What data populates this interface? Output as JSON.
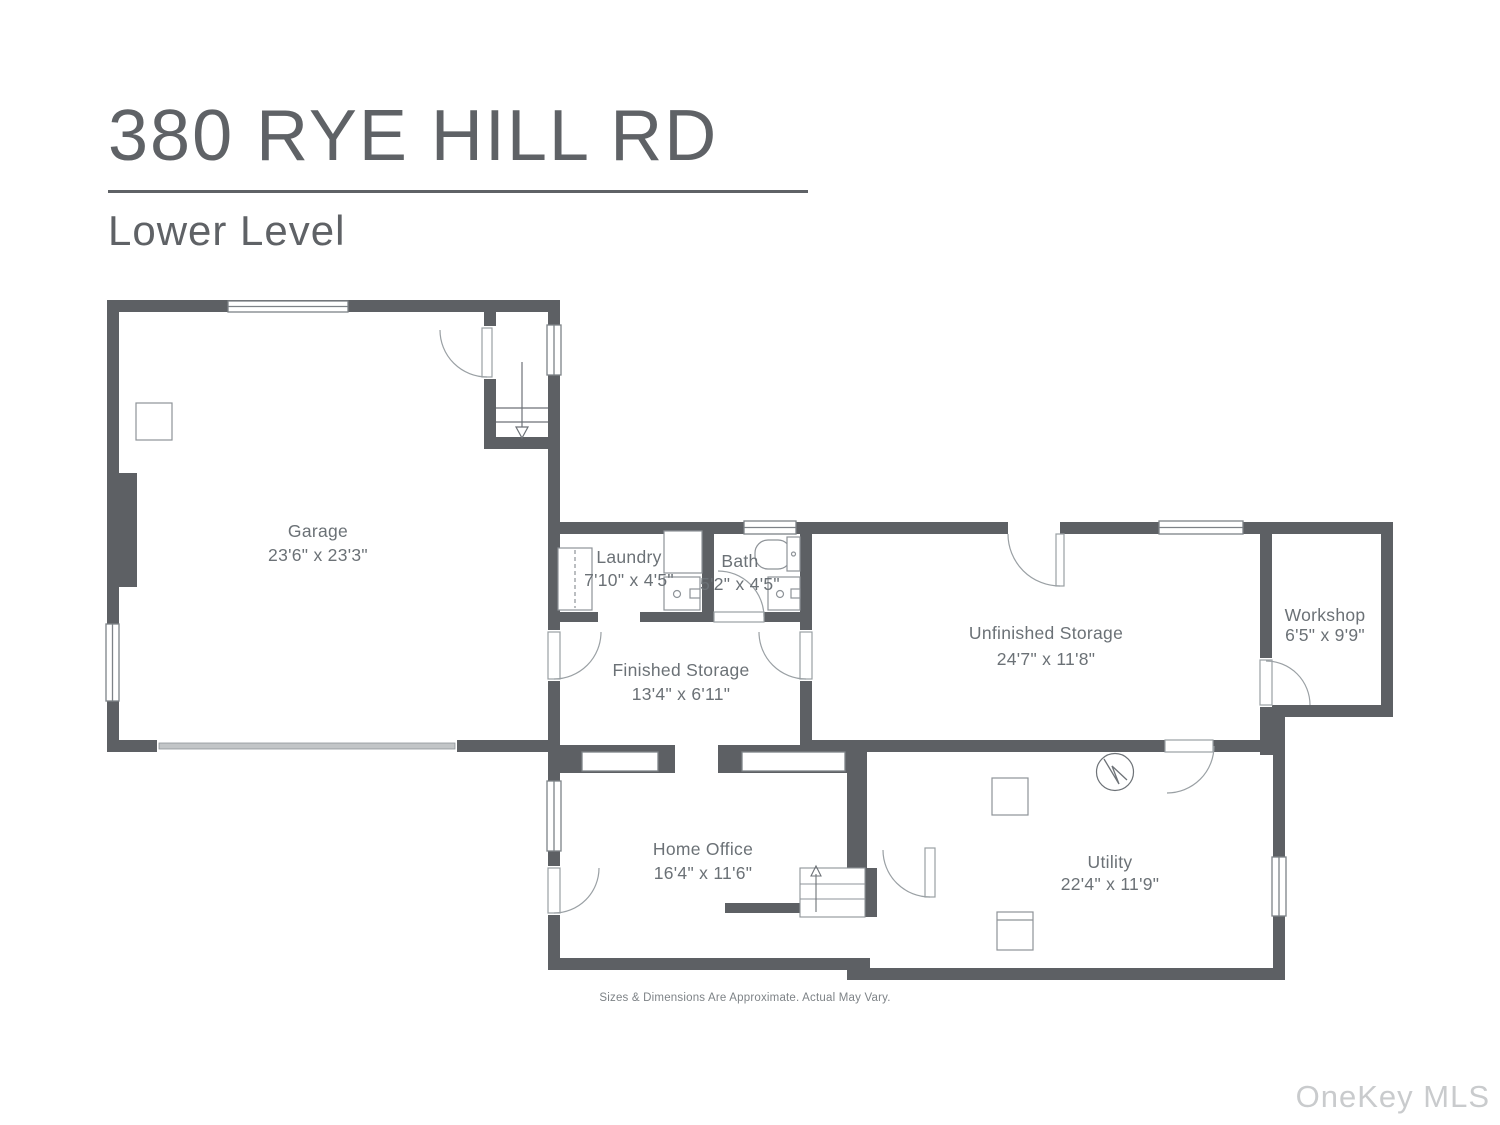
{
  "header": {
    "title": "380 RYE HILL RD",
    "subtitle": "Lower Level"
  },
  "rooms": [
    {
      "name": "Garage",
      "dims": "23'6\" x 23'3\""
    },
    {
      "name": "Laundry",
      "dims": "7'10\" x 4'5\""
    },
    {
      "name": "Bath",
      "dims": "5'2\" x 4'5\""
    },
    {
      "name": "Finished Storage",
      "dims": "13'4\" x 6'11\""
    },
    {
      "name": "Unfinished Storage",
      "dims": "24'7\" x 11'8\""
    },
    {
      "name": "Workshop",
      "dims": "6'5\" x 9'9\""
    },
    {
      "name": "Home Office",
      "dims": "16'4\" x 11'6\""
    },
    {
      "name": "Utility",
      "dims": "22'4\" x 11'9\""
    }
  ],
  "footer": {
    "disclaimer": "Sizes & Dimensions Are Approximate. Actual May Vary."
  },
  "watermark": "OneKey MLS",
  "colors": {
    "wall": "#5d6064",
    "fixture_stroke": "#8e9398",
    "window_stroke": "#7d8287",
    "label": "#6b7176",
    "title": "#5f6266",
    "garage_door_band": "#c2c5c7",
    "footer_text": "#7e8387",
    "watermark_text": "#c9cbcd"
  }
}
